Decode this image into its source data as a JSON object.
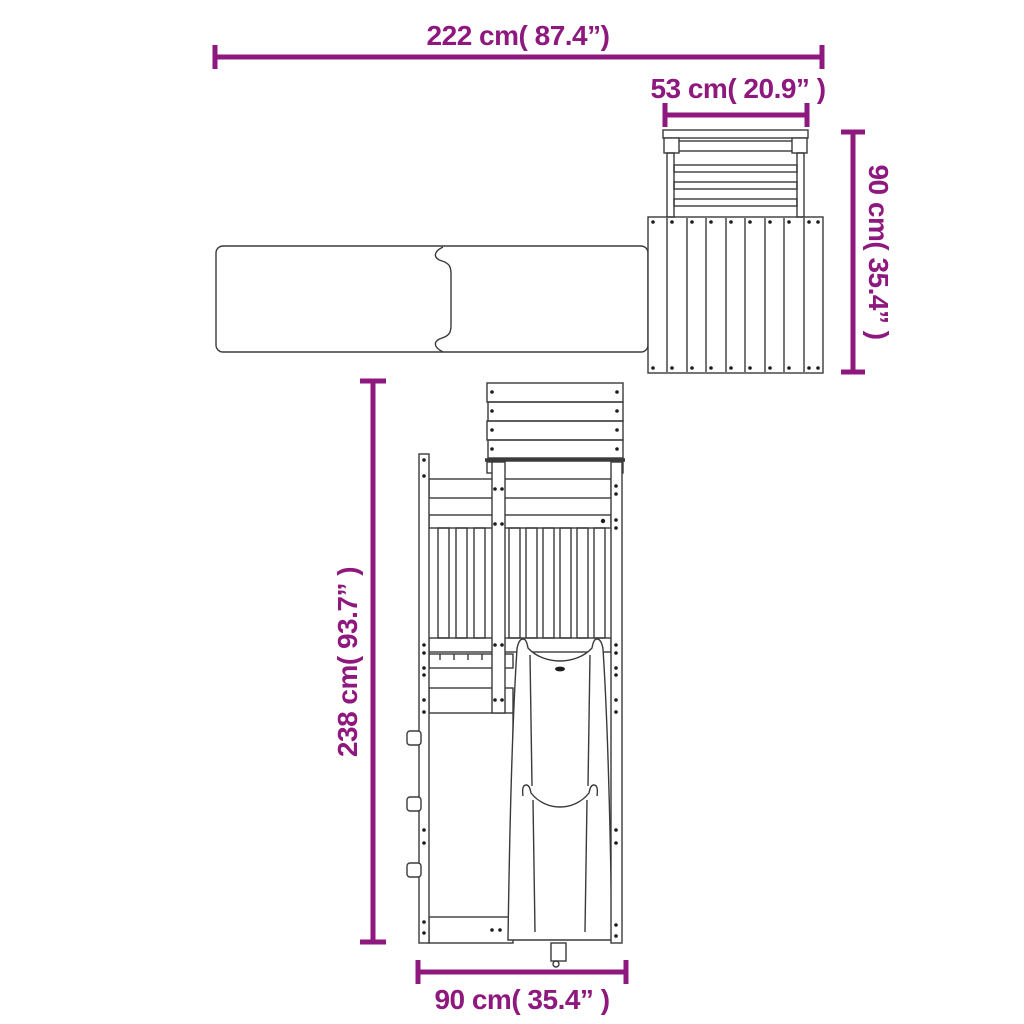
{
  "colors": {
    "dimension": "#8E187E",
    "line": "#3a3a3a",
    "dot": "#1c1c1c",
    "background": "#ffffff"
  },
  "dimensions": {
    "total_width": {
      "label": "222 cm( 87.4”)"
    },
    "ladder_width": {
      "label": "53 cm( 20.9” )"
    },
    "platform_height": {
      "label": "90 cm( 35.4” )"
    },
    "total_height": {
      "label": "238 cm( 93.7” )"
    },
    "base_width": {
      "label": "90 cm( 35.4” )"
    }
  }
}
